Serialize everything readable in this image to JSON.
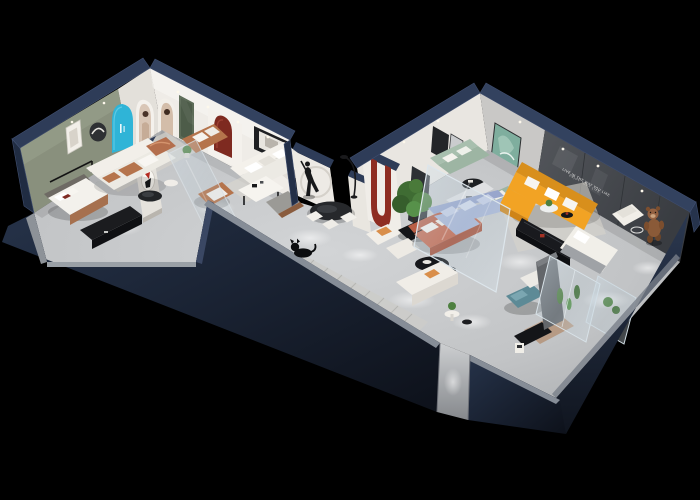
{
  "scene": {
    "type": "3d-isometric-floorplan-render",
    "setting": "furniture-showroom-cutaway",
    "background": "#000000"
  },
  "wall_slogan": {
    "line1": "LIVE IN THE WAY YOU LIKE",
    "line2": "ENJOY YOUR LIFE"
  },
  "palette": {
    "outer_wall": "#1d2736",
    "outer_wall_light": "#2e3d58",
    "wall_cap": "#32415f",
    "interior_wall": "#eae7e2",
    "olive_wall": "#89907d",
    "tv_wall": "#45484d",
    "floor": "#c5c7c9",
    "accent_blue": "#2fb4d7",
    "accent_red": "#8e2d22",
    "sofa_orange": "#f2a324",
    "sofa_coral": "#c56a50",
    "sofa_sage": "#a8bfae",
    "sofa_periwinkle": "#a9b6d6",
    "wood_caramel": "#b5744c",
    "bed_teal": "#5d8a96",
    "bed_tan": "#b69a84",
    "copper": "#b46f4d",
    "plant_green": "#4e8040",
    "glass": "#bcd2e0"
  },
  "rooms": [
    {
      "name": "bedroom-display",
      "items": [
        "double-bed",
        "black-media-console",
        "wall-frames",
        "round-wall-art"
      ]
    },
    {
      "name": "living-display-left",
      "items": [
        "white-sofa",
        "caramel-cushions",
        "black-coffee-table",
        "copper-ottoman",
        "caramel-loveseat",
        "caramel-armchair",
        "art-partition"
      ]
    },
    {
      "name": "arch-gallery",
      "items": [
        "blue-arch",
        "poster-arch-1",
        "poster-arch-2",
        "green-door",
        "red-arch-niche",
        "black-frame-art"
      ]
    },
    {
      "name": "dining-hall",
      "items": [
        "white-corner-sofa",
        "dining-table",
        "grey-armchair",
        "black-oval-table",
        "white-chairs",
        "arc-lamp",
        "human-statue",
        "circle-art-wall",
        "red-u-partition",
        "indoor-tree",
        "white-armchairs",
        "cat-figurine",
        "striped-runner"
      ]
    },
    {
      "name": "living-display-right",
      "items": [
        "orange-sectional",
        "media-console",
        "sage-sofa",
        "teal-artwork",
        "black-round-table",
        "coral-sofa",
        "organic-coffee-table",
        "white-sofa",
        "plant-side-table",
        "periwinkle-sectional",
        "display-cabinet",
        "glass-partition",
        "white-armchair",
        "teddy-bear-figure"
      ]
    },
    {
      "name": "bedding-display",
      "items": [
        "white-bed",
        "grey-blanket",
        "teal-ottoman",
        "tan-bed",
        "black-floor-mat",
        "magazine-rack",
        "grey-partition",
        "glass-display-cases",
        "cactus-plants"
      ]
    }
  ]
}
